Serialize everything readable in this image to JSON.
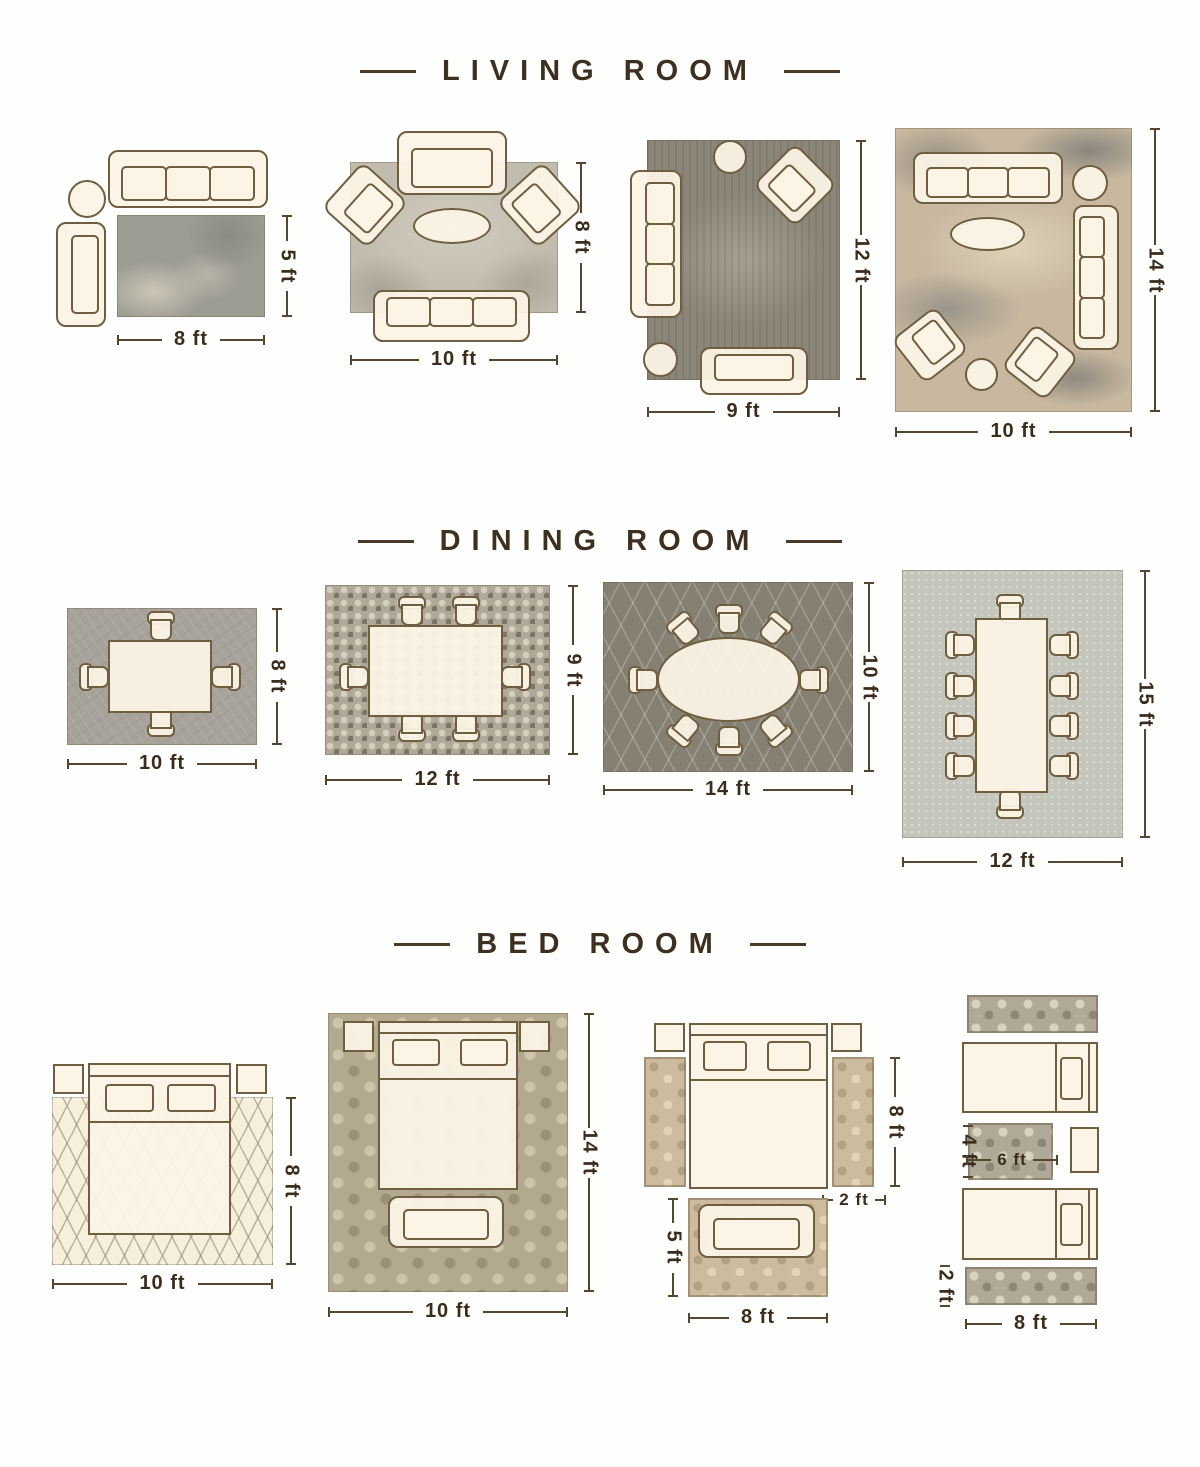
{
  "colors": {
    "heading_text": "#3e3020",
    "dimension_text": "#3b2d1d",
    "dimension_line": "#57462f",
    "furniture_outline": "#6f5e40",
    "furniture_fill": "#fcf4e6"
  },
  "sections": [
    {
      "title": "LIVING ROOM",
      "layouts": [
        {
          "name": "sofa-loveseat-rug",
          "width": "8 ft",
          "height": "5 ft"
        },
        {
          "name": "sofa-two-armchairs-rug",
          "width": "10 ft",
          "height": "8 ft"
        },
        {
          "name": "sofa-loveseat-armchair-rug",
          "width": "9 ft",
          "height": "12 ft"
        },
        {
          "name": "two-sofas-two-armchairs-rug",
          "width": "10 ft",
          "height": "14 ft"
        }
      ]
    },
    {
      "title": "DINING ROOM",
      "layouts": [
        {
          "name": "table-4-chairs-rug",
          "width": "10 ft",
          "height": "8 ft"
        },
        {
          "name": "table-6-chairs-rug",
          "width": "12 ft",
          "height": "9 ft"
        },
        {
          "name": "oval-table-8-chairs-rug",
          "width": "14 ft",
          "height": "10 ft"
        },
        {
          "name": "table-10-chairs-rug",
          "width": "12 ft",
          "height": "15 ft"
        }
      ]
    },
    {
      "title": "BED ROOM",
      "layouts": [
        {
          "name": "bed-on-rug",
          "width": "10 ft",
          "height": "8 ft"
        },
        {
          "name": "bed-bench-on-rug",
          "width": "10 ft",
          "height": "14 ft"
        },
        {
          "name": "bed-side-runners-bench-rug",
          "runner_height": "8 ft",
          "runner_width": "2 ft",
          "bench_rug_height": "5 ft",
          "bench_rug_width": "8 ft"
        },
        {
          "name": "twin-beds-runners",
          "side_rug_height": "4 ft",
          "side_rug_width": "6 ft",
          "runner_width": "2 ft",
          "runner_length": "8 ft"
        }
      ]
    }
  ]
}
